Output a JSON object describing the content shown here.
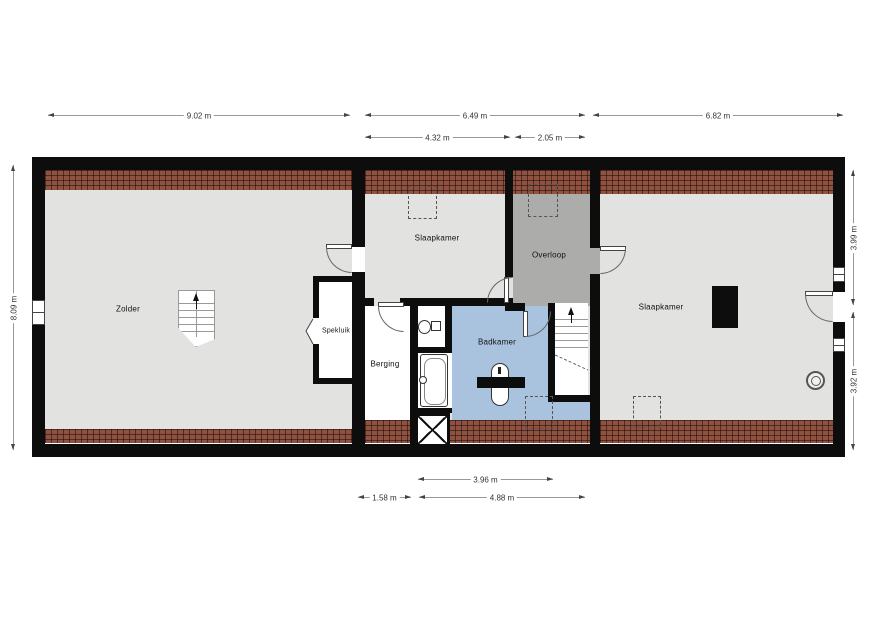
{
  "rooms": {
    "zolder": {
      "label": "Zolder"
    },
    "slaapkamer_mid": {
      "label": "Slaapkamer"
    },
    "overloop": {
      "label": "Overloop"
    },
    "spekluik": {
      "label": "Spekluik"
    },
    "berging": {
      "label": "Berging"
    },
    "badkamer": {
      "label": "Badkamer"
    },
    "slaapkamer_right": {
      "label": "Slaapkamer"
    }
  },
  "dimensions": {
    "top_zolder": "9.02 m",
    "top_middle_total": "6.49 m",
    "top_middle_left": "4.32 m",
    "top_middle_right": "2.05 m",
    "top_right": "6.82 m",
    "left_height": "8.09 m",
    "right_top": "3.99 m",
    "right_bottom": "3.92 m",
    "bottom_inner": "3.96 m",
    "bottom_berging": "1.58 m",
    "bottom_badkamer": "4.88 m"
  },
  "colors": {
    "wall": "#0d0d0d",
    "floor": "#e2e2e0",
    "landing_floor": "#acacaa",
    "bathroom_floor": "#a9c3df",
    "brick_hatch": "#8f5240",
    "dimension_text": "#333333"
  },
  "icons": {
    "stairs_direction": "up-arrow-icon",
    "shaft": "x-cross-icon",
    "ventilation": "double-circle-icon"
  }
}
